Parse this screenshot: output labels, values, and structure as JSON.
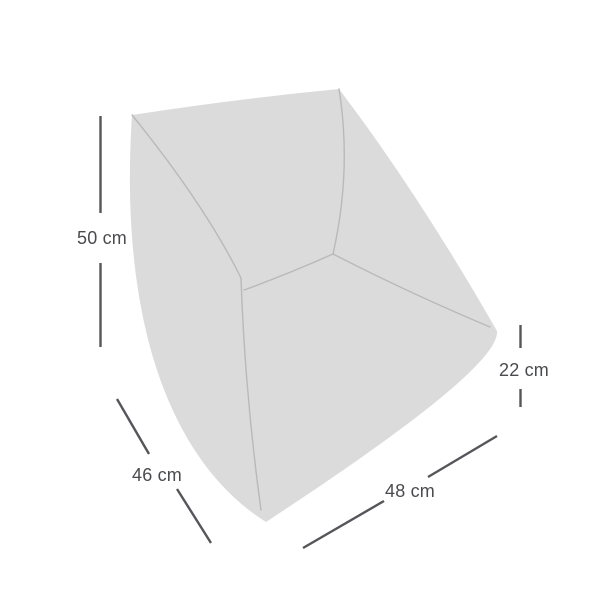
{
  "diagram": {
    "type": "product-dimension-diagram",
    "subject": "upholstered modular chair / seat module",
    "unit": "cm",
    "dimensions": {
      "height": {
        "label": "50 cm",
        "value": 50
      },
      "depth": {
        "label": "46 cm",
        "value": 46
      },
      "width": {
        "label": "48 cm",
        "value": 48
      },
      "seat_height": {
        "label": "22 cm",
        "value": 22
      }
    }
  },
  "colors": {
    "background": "#ffffff",
    "chair_fill": "#dbdbdb",
    "seam_stroke": "#b9b9b9",
    "dimension_line": "#55565a",
    "label_text": "#4a4b4e"
  }
}
